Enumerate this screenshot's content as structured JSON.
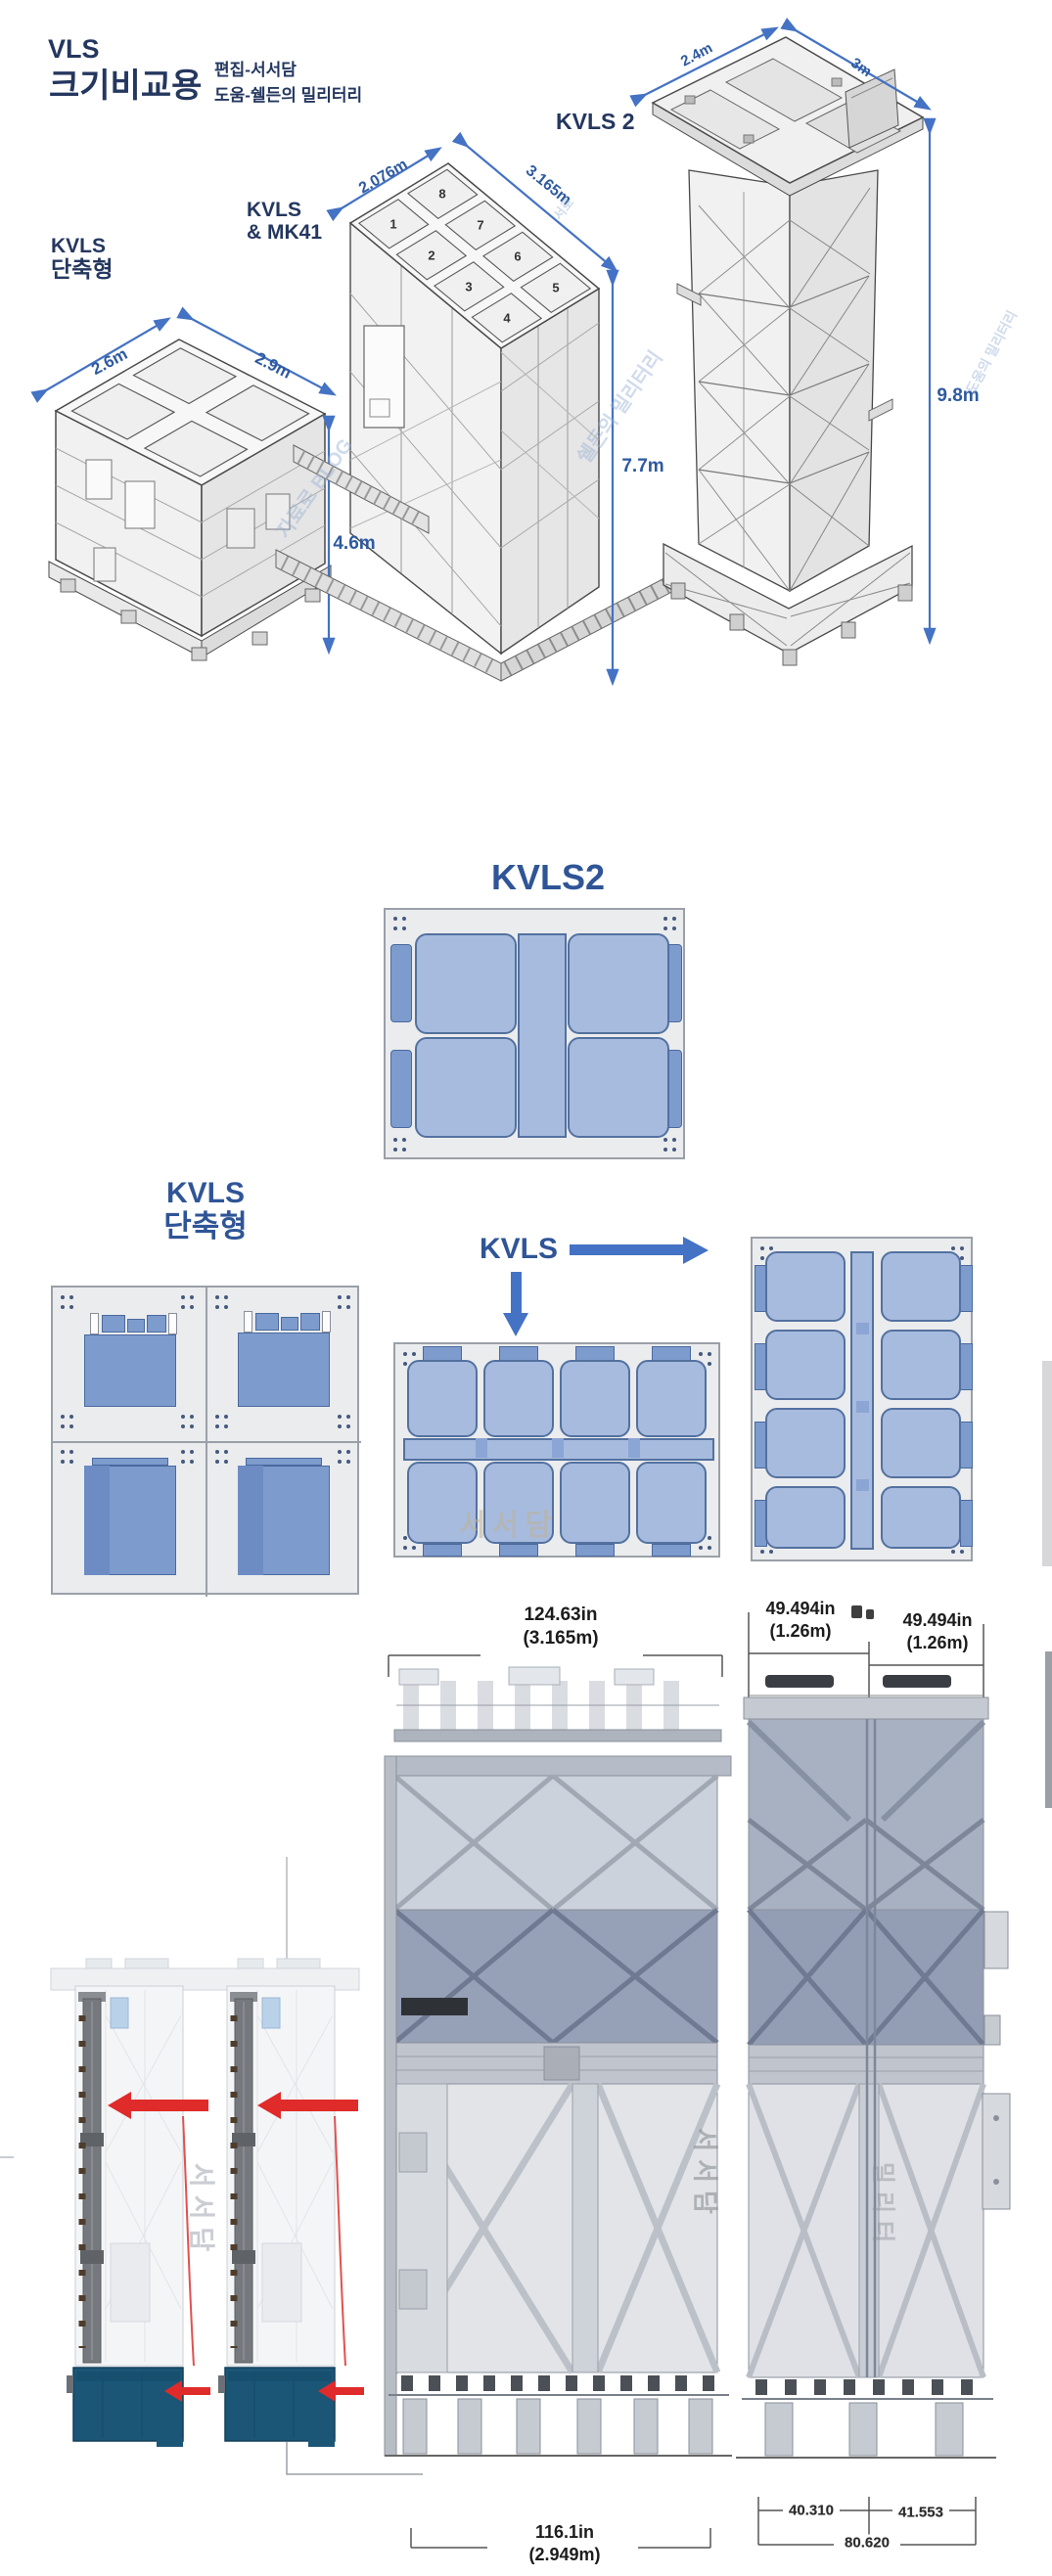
{
  "colors": {
    "title_navy": "#24375f",
    "label_blue": "#2f5597",
    "dim_blue": "#2e5aa0",
    "arrow_blue": "#4472c4",
    "hatch_fill": "#a7bbdf",
    "hatch_border": "#53719f",
    "tab_fill": "#7e9bce",
    "panel_bg": "#ebecee",
    "red_arrow": "#e02b2b",
    "plenum_navy": "#1b5677"
  },
  "header": {
    "title1": "VLS",
    "title2": "크기비교용",
    "credit1": "편집-서서담",
    "credit2": "도움-쉘든의 밀리터리"
  },
  "iso": {
    "kvls_short": {
      "label1": "KVLS",
      "label2": "단축형",
      "w1": "2.6m",
      "w2": "2.9m",
      "h": "4.6m"
    },
    "kvls_mk41": {
      "label1": "KVLS",
      "label2": "& MK41",
      "w1": "2.076m",
      "w2": "3.165m",
      "h": "7.7m",
      "cells": [
        "1",
        "2",
        "3",
        "4",
        "5",
        "6",
        "7",
        "8"
      ]
    },
    "kvls2": {
      "label": "KVLS 2",
      "w1": "2.4m",
      "w2": "3m",
      "h": "9.8m"
    }
  },
  "topviews": {
    "kvls2_title": "KVLS2",
    "short_label1": "KVLS",
    "short_label2": "단축형",
    "kvls_label": "KVLS"
  },
  "watermarks": {
    "w1": "자료로 BLOG",
    "w2": "쉘든의 밀리터리",
    "w3": "도움의 밀리터리",
    "w4": "서로",
    "panel": "서서담",
    "bottom_left": "서서담",
    "bottom_mid": "서서담",
    "bottom_right": "밀리터"
  },
  "bottom_dims": {
    "mid_w_in": "124.63in",
    "mid_w_m": "(3.165m)",
    "r1_in": "49.494in",
    "r1_m": "(1.26m)",
    "r2_in": "49.494in",
    "r2_m": "(1.26m)",
    "mid_b_in": "116.1in",
    "mid_b_m": "(2.949m)",
    "rb_left": "40.310",
    "rb_right": "41.553",
    "rb_total": "80.620"
  }
}
